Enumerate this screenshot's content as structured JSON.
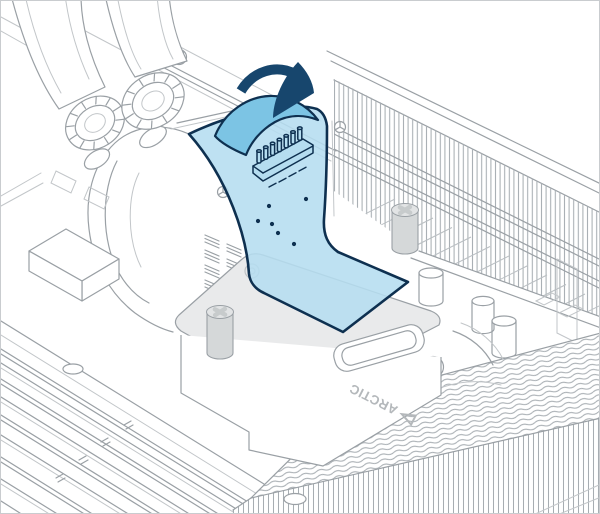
{
  "canvas": {
    "width": 600,
    "height": 514
  },
  "diagram": {
    "logo_text": "ARCTIC",
    "icons": {
      "direction_arrow": "curved-down-arrow-icon"
    },
    "colors": {
      "background": "#ffffff",
      "border_gray": "#c9cccf",
      "line": "#9aa0a5",
      "line_light": "#c2c6c9",
      "fill_gray": "#e9eaeb",
      "standoff_gray": "#d5d8d9",
      "film_blue": "#b5ddf0",
      "fold_blue": "#7cc4e4",
      "outline_navy": "#0e3050",
      "arrow_navy": "#17466d",
      "logo_gray": "#b4b8bb",
      "fin_line": "#a7adb2"
    }
  }
}
